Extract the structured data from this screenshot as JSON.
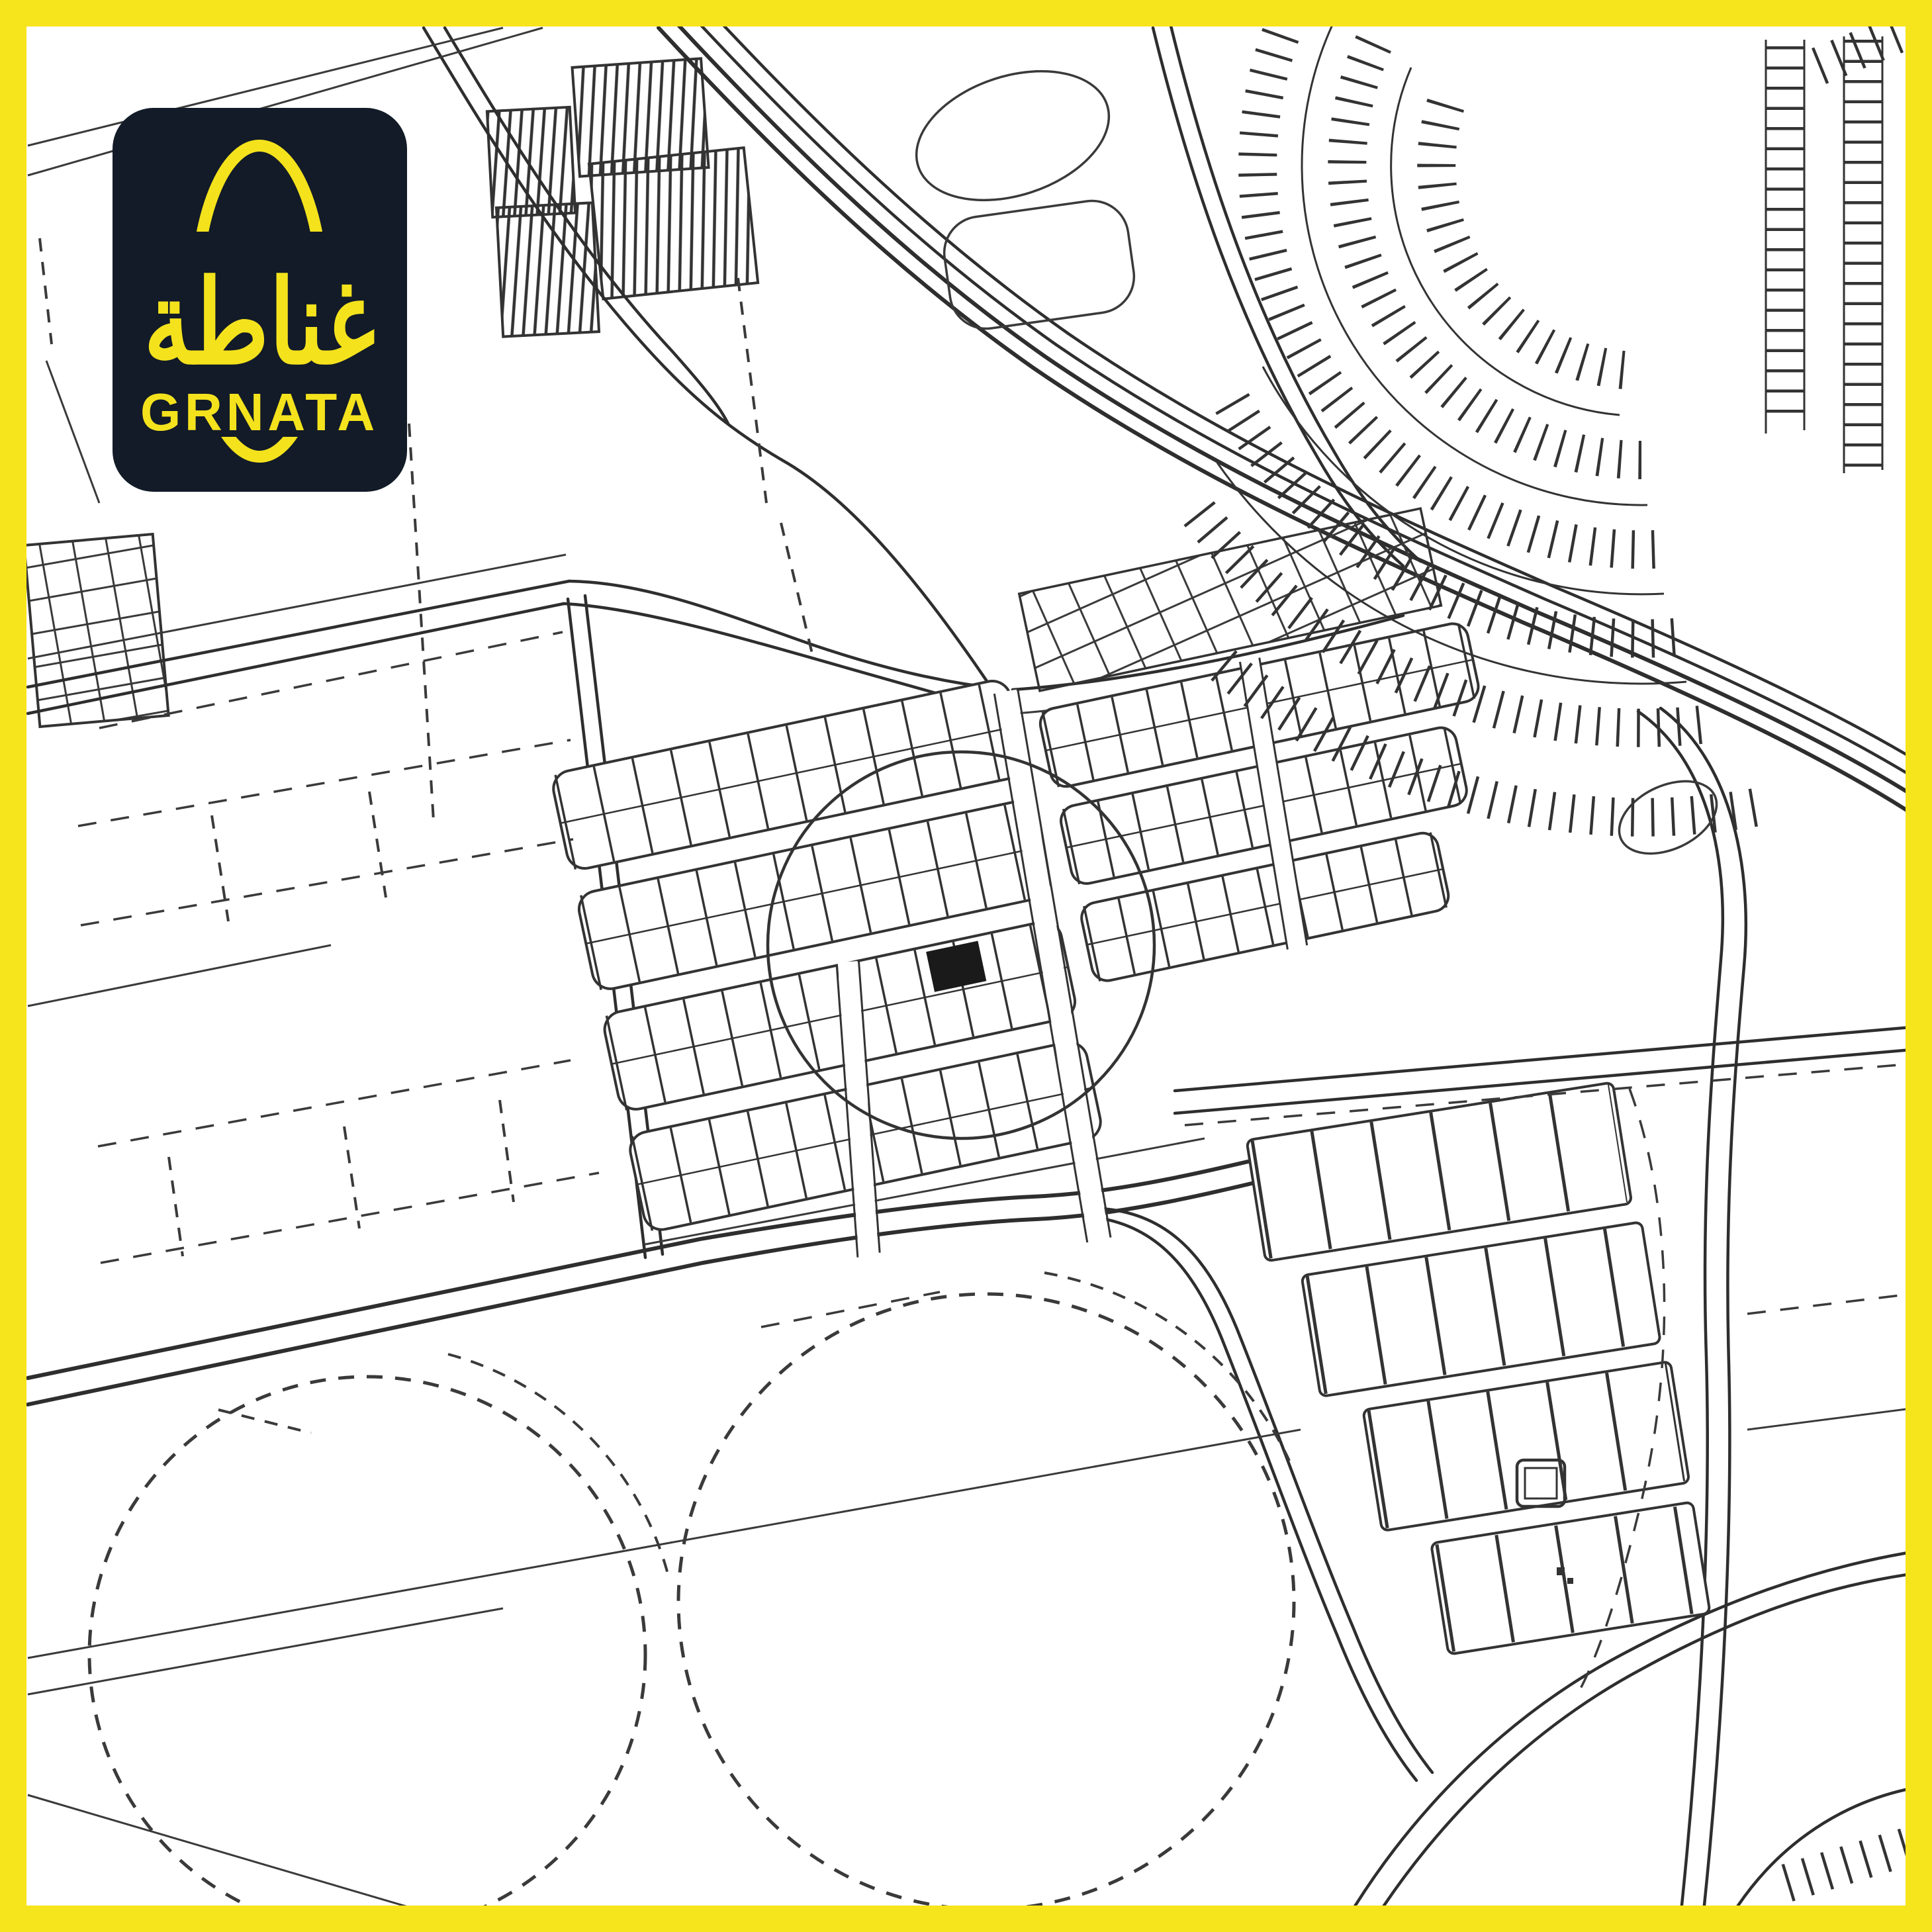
{
  "poster": {
    "frame_color": "#F6E41C",
    "paper_color": "#FFFFFF",
    "ink_color": "#333333"
  },
  "logo": {
    "arabic_wordmark": "غناطة",
    "latin_wordmark": "GRNATA",
    "background_color": "#121B27",
    "accent_color": "#F4E21D"
  },
  "map": {
    "type": "cadastral-plan",
    "highlighted_plot_color": "#1A1A1A"
  }
}
